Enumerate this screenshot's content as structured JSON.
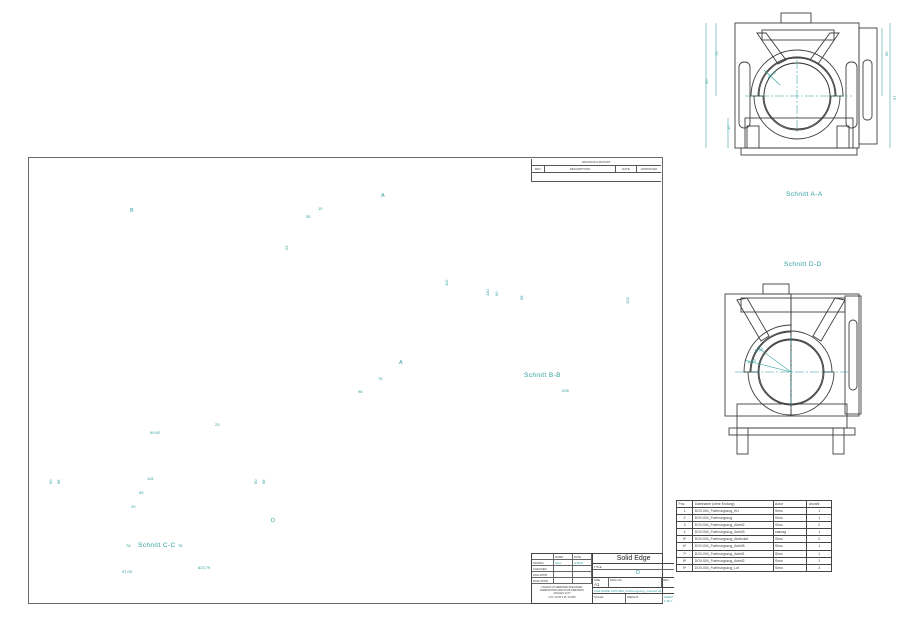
{
  "colors": {
    "annotation": "#2f9e9e",
    "line": "#3f3f3f",
    "green": "#a9e2a4",
    "green_bright": "#66d06a",
    "yellow": "#e7da7e",
    "red_muted": "#dc9a94",
    "red_strong": "#cf4f4f",
    "blue": "#aac9ea",
    "gray_section": "#b5b5b5"
  },
  "labels": {
    "schnitt_aa": "Schnitt A-A",
    "schnitt_bb": "Schnitt B-B",
    "schnitt_cc": "Schnitt C-C",
    "schnitt_dd": "Schnitt D-D",
    "marker_a": "A",
    "marker_b": "B",
    "marker_d": "D"
  },
  "revision_table": {
    "title": "REVISION HISTORY",
    "columns": [
      "REV",
      "DESCRIPTION",
      "DATE",
      "APPROVED"
    ]
  },
  "title_block": {
    "name_col": "NAME",
    "date_col": "DATE",
    "rows": [
      {
        "label": "DRAWN",
        "name": "Simo",
        "date": "4/18/21"
      },
      {
        "label": "CHECKED",
        "name": "",
        "date": ""
      },
      {
        "label": "ENG APPR",
        "name": "",
        "date": ""
      },
      {
        "label": "MGR APPR",
        "name": "",
        "date": ""
      }
    ],
    "tolerance_note": [
      "UNLESS OTHERWISE SPECIFIED:",
      "DIMENSIONS ARE IN MILLIMETERS",
      "ANGLES ±0.5°",
      "2 PL ±0.25  3 PL ±0.005"
    ],
    "product": "Solid Edge",
    "title_label": "TITLE",
    "size_label": "SIZE",
    "size": "A1",
    "dwg_no_label": "DWG NO",
    "rev_label": "REV",
    "file_name": "FILE NAME: DOV-004_Fuehrungszug_montiert.dft",
    "scale_label": "SCALE:",
    "weight_label": "WEIGHT:",
    "sheet_label": "SHEET 1 OF 1"
  },
  "parts_list": {
    "columns": [
      "Pos.",
      "Dateiname (ohne Endung)",
      "Autor",
      "Anzahl"
    ],
    "rows": [
      [
        "1",
        "DOV-004_Fuehrungszug_KU",
        "Simo",
        "1"
      ],
      [
        "2",
        "DOV-004_Fuehrungszug",
        "Simo",
        "1"
      ],
      [
        "3",
        "DOV-004_Fuehrungszug_Anteil2",
        "Simo",
        "2"
      ],
      [
        "4",
        "DOV-004_Fuehrungszug_Anteil3",
        "csanag",
        "1"
      ],
      [
        "5*",
        "DOV-004_Fuehrungszug_Abdeckel",
        "Simo",
        "2"
      ],
      [
        "6*",
        "DOV-004_Fuehrungszug_Anteil5",
        "Simo",
        "1"
      ],
      [
        "7*",
        "DOV-004_Fuehrungszug_Anteil1",
        "Simo",
        "1"
      ],
      [
        "8*",
        "DOV-004_Fuehrungszug_Anteil2",
        "Simo",
        "1"
      ],
      [
        "9*",
        "DOV-004_Fuehrungszug_Luf",
        "Simo",
        "4"
      ]
    ]
  },
  "dimensions": [
    {
      "x": 704,
      "y": 84,
      "t": "90",
      "r": -90
    },
    {
      "x": 714,
      "y": 56,
      "t": "75",
      "r": -90
    },
    {
      "x": 884,
      "y": 56,
      "t": "90",
      "r": -90
    },
    {
      "x": 892,
      "y": 100,
      "t": "97",
      "r": -90
    },
    {
      "x": 726,
      "y": 130,
      "t": "15",
      "r": -90
    },
    {
      "x": 766,
      "y": 76,
      "t": "40 H7",
      "r": -38
    },
    {
      "x": 318,
      "y": 206,
      "t": "10"
    },
    {
      "x": 306,
      "y": 214,
      "t": "35"
    },
    {
      "x": 284,
      "y": 250,
      "t": "25",
      "r": -90
    },
    {
      "x": 444,
      "y": 286,
      "t": "110",
      "r": -90
    },
    {
      "x": 378,
      "y": 376,
      "t": "76"
    },
    {
      "x": 358,
      "y": 389,
      "t": "96"
    },
    {
      "x": 494,
      "y": 296,
      "t": "90",
      "r": -90
    },
    {
      "x": 485,
      "y": 296,
      "t": "140",
      "r": -90
    },
    {
      "x": 519,
      "y": 300,
      "t": "58",
      "r": -90
    },
    {
      "x": 625,
      "y": 304,
      "t": "103",
      "r": -90
    },
    {
      "x": 562,
      "y": 388,
      "t": "206"
    },
    {
      "x": 754,
      "y": 349,
      "t": "R 40",
      "r": -20
    },
    {
      "x": 747,
      "y": 360,
      "t": "R 33",
      "r": -15
    },
    {
      "x": 150,
      "y": 430,
      "t": "99.92"
    },
    {
      "x": 215,
      "y": 422,
      "t": "23"
    },
    {
      "x": 56,
      "y": 484,
      "t": "88",
      "r": -90
    },
    {
      "x": 48,
      "y": 484,
      "t": "60",
      "r": -90
    },
    {
      "x": 253,
      "y": 484,
      "t": "90",
      "r": -90
    },
    {
      "x": 261,
      "y": 484,
      "t": "98",
      "r": -90
    },
    {
      "x": 126,
      "y": 543,
      "t": "78"
    },
    {
      "x": 178,
      "y": 543,
      "t": "78"
    },
    {
      "x": 122,
      "y": 569,
      "t": "97.09"
    },
    {
      "x": 198,
      "y": 565,
      "t": "623.79"
    },
    {
      "x": 147,
      "y": 476,
      "t": "115"
    },
    {
      "x": 139,
      "y": 490,
      "t": "65"
    },
    {
      "x": 131,
      "y": 504,
      "t": "20"
    }
  ]
}
